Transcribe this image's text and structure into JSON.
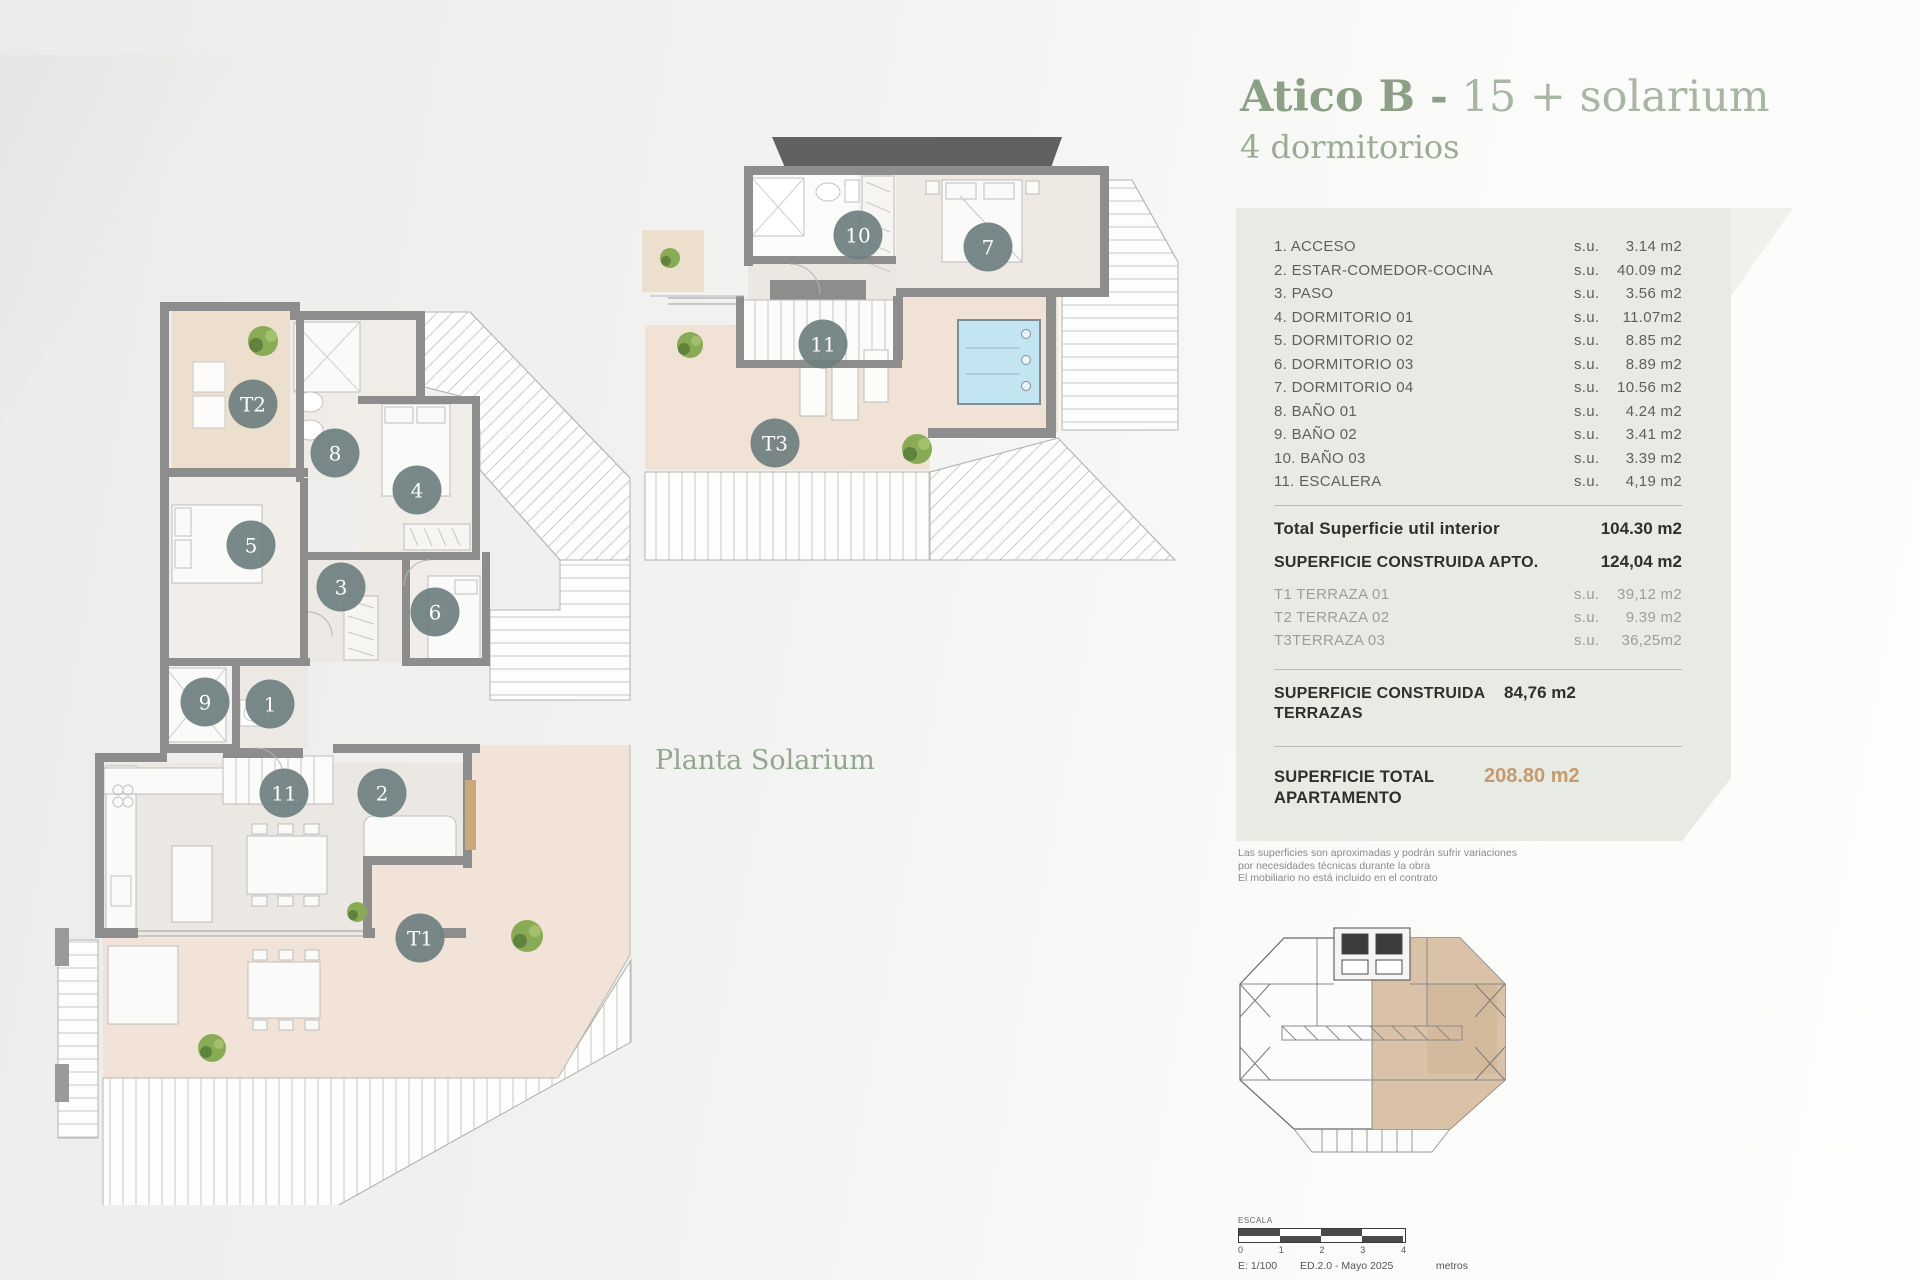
{
  "title": {
    "main": "Atico B -",
    "sub": " 15 + solarium",
    "line2": "4 dormitorios"
  },
  "plans": {
    "solarium_caption": "Planta Solarium",
    "main_markers": [
      {
        "label": "1",
        "x": 270,
        "y": 704
      },
      {
        "label": "2",
        "x": 382,
        "y": 793
      },
      {
        "label": "3",
        "x": 341,
        "y": 587
      },
      {
        "label": "4",
        "x": 417,
        "y": 490
      },
      {
        "label": "5",
        "x": 251,
        "y": 545
      },
      {
        "label": "6",
        "x": 435,
        "y": 612
      },
      {
        "label": "8",
        "x": 335,
        "y": 453
      },
      {
        "label": "9",
        "x": 205,
        "y": 702
      },
      {
        "label": "11",
        "x": 284,
        "y": 793
      },
      {
        "label": "T1",
        "x": 420,
        "y": 938
      },
      {
        "label": "T2",
        "x": 253,
        "y": 404
      }
    ],
    "solarium_markers": [
      {
        "label": "7",
        "x": 988,
        "y": 247
      },
      {
        "label": "10",
        "x": 858,
        "y": 235
      },
      {
        "label": "11",
        "x": 823,
        "y": 344
      },
      {
        "label": "T3",
        "x": 775,
        "y": 443
      }
    ]
  },
  "panel": {
    "rooms": [
      {
        "label": "1. ACCESO",
        "su": "s.u.",
        "value": "3.14 m2"
      },
      {
        "label": "2. ESTAR-COMEDOR-COCINA",
        "su": "s.u.",
        "value": "40.09 m2"
      },
      {
        "label": "3. PASO",
        "su": "s.u.",
        "value": "3.56 m2"
      },
      {
        "label": "4. DORMITORIO 01",
        "su": "s.u.",
        "value": "11.07m2"
      },
      {
        "label": "5. DORMITORIO 02",
        "su": "s.u.",
        "value": "8.85  m2"
      },
      {
        "label": "6. DORMITORIO 03",
        "su": "s.u.",
        "value": "8.89  m2"
      },
      {
        "label": "7. DORMITORIO 04",
        "su": "s.u.",
        "value": "10.56 m2"
      },
      {
        "label": "8. BAÑO 01",
        "su": "s.u.",
        "value": "4.24 m2"
      },
      {
        "label": "9. BAÑO 02",
        "su": "s.u.",
        "value": "3.41 m2"
      },
      {
        "label": "10. BAÑO 03",
        "su": "s.u.",
        "value": "3.39 m2"
      },
      {
        "label": "11. ESCALERA",
        "su": "s.u.",
        "value": "4,19 m2"
      }
    ],
    "total_util": {
      "label": "Total Superficie util interior",
      "value": "104.30 m2"
    },
    "construida_apto": {
      "label": "SUPERFICIE CONSTRUIDA APTO.",
      "value": "124,04 m2"
    },
    "terrazas": [
      {
        "label": "T1 TERRAZA 01",
        "su": "s.u.",
        "value": "39,12 m2"
      },
      {
        "label": "T2 TERRAZA 02",
        "su": "s.u.",
        "value": "9.39 m2"
      },
      {
        "label": "T3TERRAZA 03",
        "su": "s.u.",
        "value": "36,25m2"
      }
    ],
    "construida_terrazas": {
      "label": "SUPERFICIE CONSTRUIDA TERRAZAS",
      "value": "84,76 m2"
    },
    "total_apartamento": {
      "label": "SUPERFICIE TOTAL APARTAMENTO",
      "value": "208.80 m2"
    }
  },
  "disclaimer": [
    "Las superficies son aproximadas y podrán sufrir variaciones",
    "por necesidades técnicas durante la obra",
    "El mobiliario no está incluido en el contrato"
  ],
  "scalebar": {
    "escala": "ESCALA",
    "ticks": [
      "0",
      "1",
      "2",
      "3",
      "4"
    ],
    "scale": "E: 1/100",
    "edition": "ED.2.0 - Mayo 2025",
    "unit": "metros"
  },
  "colors": {
    "accent_green": "#8ba084",
    "panel_bg": "#e8ebe3",
    "highlight_tan": "#c49a6e",
    "terrace_beige": "#ecdfce",
    "pool_blue": "#c3e5f1",
    "marker": "#6f7f80",
    "wall_gray": "#8d8d8d",
    "locator_tan": "#d9c2a7"
  }
}
